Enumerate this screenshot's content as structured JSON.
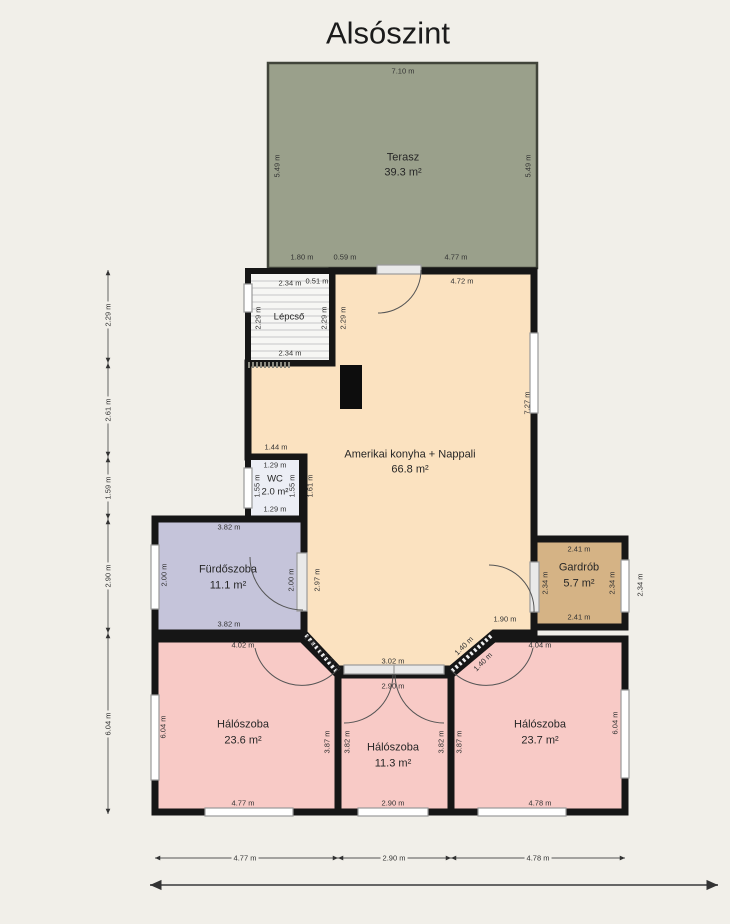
{
  "title": "Alsószint",
  "rooms": {
    "terasz": {
      "name": "Terasz",
      "area": "39.3 m²"
    },
    "lepcso": {
      "name": "Lépcső"
    },
    "nappali": {
      "name": "Amerikai konyha + Nappali",
      "area": "66.8 m²"
    },
    "wc": {
      "name": "WC",
      "area": "2.0 m²"
    },
    "furdoszoba": {
      "name": "Fürdőszoba",
      "area": "11.1 m²"
    },
    "gardrob": {
      "name": "Gardrób",
      "area": "5.7 m²"
    },
    "halo_bal": {
      "name": "Hálószoba",
      "area": "23.6 m²"
    },
    "halo_kozep": {
      "name": "Hálószoba",
      "area": "11.3 m²"
    },
    "halo_jobb": {
      "name": "Hálószoba",
      "area": "23.7 m²"
    }
  },
  "dims": {
    "terrace_top": "7.10 m",
    "terrace_left": "5.49 m",
    "terrace_right": "5.49 m",
    "seg_1": "1.80 m",
    "seg_2": "0.59 m",
    "seg_3": "4.77 m",
    "stairs_top": "2.34 m",
    "stairs_bottom": "2.34 m",
    "stairs_left": "2.29 m",
    "stairs_right": "2.29 m",
    "main_left": "2.29 m",
    "main_top_a": "0.51 m",
    "main_top_b": "4.72 m",
    "main_right": "7.27 m",
    "main_above_wc": "1.44 m",
    "main_bottom_right": "1.90 m",
    "wc_top": "1.29 m",
    "wc_bottom": "1.29 m",
    "wc_side_l": "1.55 m",
    "wc_side_r": "1.55 m",
    "wc_right_out": "1.61 m",
    "bath_top": "3.82 m",
    "bath_bottom": "3.82 m",
    "bath_left": "2.00 m",
    "bath_door": "2.00 m",
    "bath_right_out": "2.97 m",
    "gard_top": "2.41 m",
    "gard_bottom": "2.41 m",
    "gard_left": "2.34 m",
    "gard_right": "2.34 m",
    "gard_out": "2.34 m",
    "bl_top": "4.02 m",
    "bl_left": "6.04 m",
    "bl_right": "3.87 m",
    "bl_bottom": "4.77 m",
    "bm_top": "3.02 m",
    "bm_door": "2.90 m",
    "bm_left": "3.82 m",
    "bm_right": "3.82 m",
    "bm_bottom": "2.90 m",
    "br_top": "4.04 m",
    "br_left": "3.87 m",
    "br_right": "6.04 m",
    "br_bottom": "4.78 m",
    "diag_l1": "1.40 m",
    "diag_l2": "1.40 m",
    "diag_r1": "1.40 m",
    "diag_r2": "1.40 m",
    "rail_l1": "2.29 m",
    "rail_l2": "2.61 m",
    "rail_l3": "1.59 m",
    "rail_l4": "2.90 m",
    "rail_l5": "6.04 m",
    "rail_b1": "4.77 m",
    "rail_b2": "2.90 m",
    "rail_b3": "4.78 m"
  },
  "colors": {
    "terrace": "#9aa08b",
    "living": "#fbe2c0",
    "bath": "#c5c4da",
    "wardrobe": "#d5b385",
    "bedroom": "#f8cac6",
    "wc": "#eceef5",
    "stairs": "#f6f6f4",
    "wall": "#161616",
    "background": "#f1efe9",
    "window": "#ffffff",
    "stove": "#0d0d0d"
  }
}
